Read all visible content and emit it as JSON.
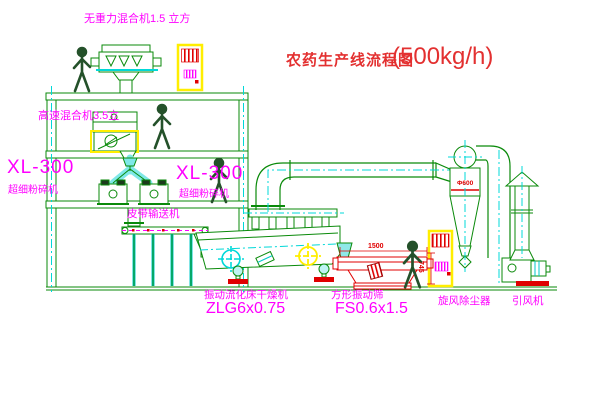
{
  "title": {
    "text": "农药生产线流程图",
    "capacity": "(500kg/h)"
  },
  "equipment_labels": {
    "gravity_mixer": "无重力混合机1.5 立方",
    "high_speed_mixer": "高速混合机3.5立",
    "mill_left_model": "XL-300",
    "mill_left_name": "超细粉碎机",
    "mill_right_model": "XL-300",
    "mill_right_name": "超细粉碎机",
    "belt_conveyor": "皮带输送机",
    "dryer_name": "振动流化床干燥机",
    "dryer_model": "ZLG6x0.75",
    "sieve_name": "方形振动筛",
    "sieve_model": "FS0.6x1.5",
    "cyclone": "旋风除尘器",
    "fan": "引风机"
  },
  "dimensions": {
    "cyclone_diameter": "Φ600",
    "sieve_width": "1500",
    "sieve_height": "745"
  },
  "colors": {
    "equipment_green": "#0a8a0a",
    "label_magenta": "#ff00ff",
    "title_red": "#e33030",
    "detail_red": "#e00000",
    "highlight_yellow": "#ffee00",
    "centerline_cyan": "#00d8d8",
    "background": "#ffffff"
  }
}
